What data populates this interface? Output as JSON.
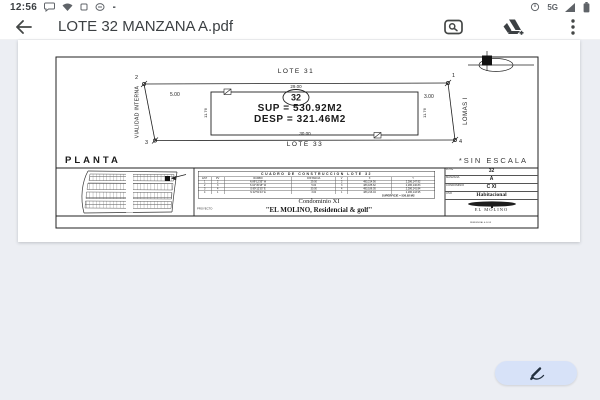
{
  "status_bar": {
    "time": "12:56",
    "network_label": "5G"
  },
  "toolbar": {
    "title": "LOTE 32 MANZANA A.pdf"
  },
  "plan": {
    "lote_top": "LOTE 31",
    "lote_bottom": "LOTE 33",
    "dim_top": "29.00",
    "dim_bottom": "30.00",
    "dim_left": "5.00",
    "dim_right": "3.00",
    "dim_side_left": "11.76",
    "dim_side_right": "11.76",
    "street_left": "VIALIDAD INTERNA",
    "street_right": "LOMAS I",
    "corner_tl": "2",
    "corner_tr": "1",
    "corner_bl": "3",
    "corner_br": "4",
    "lot_number": "32",
    "sup_text": "SUP = 530.92M2",
    "desp_text": "DESP = 321.46M2",
    "planta_label": "PLANTA",
    "scale_note": "*SIN ESCALA"
  },
  "cuadro": {
    "caption": "CUADRO DE CONSTRUCCION - LOTE 32",
    "title": "CUADRO DE CONSTRUCCION   LOTE 32",
    "columns": {
      "est": "EST",
      "pv": "PV",
      "rumbo": "RUMBO",
      "distancia": "DISTANCIA",
      "v": "V",
      "x": "X",
      "y": "Y"
    },
    "rows": [
      {
        "est": "1",
        "pv": "2",
        "rumbo": "N 89°12'35\" W",
        "dist": "29.00",
        "v": "2",
        "x": "483,214.56",
        "y": "2,286,147.92"
      },
      {
        "est": "2",
        "pv": "3",
        "rumbo": "S 04°45'18\" W",
        "dist": "5.00",
        "v": "3",
        "x": "483,185.62",
        "y": "2,286,146.83"
      },
      {
        "est": "3",
        "pv": "4",
        "rumbo": "S 89°12'35\" E",
        "dist": "30.00",
        "v": "4",
        "x": "483,186.05",
        "y": "2,286,141.84"
      },
      {
        "est": "4",
        "pv": "1",
        "rumbo": "N 02°51'44\" E",
        "dist": "3.00",
        "v": "1",
        "x": "483,216.04",
        "y": "2,286,143.95"
      }
    ],
    "footer": "SUPERFICIE = 530.92 M2"
  },
  "condominio": {
    "side_label": "PROYECTO",
    "line1": "Condominio XI",
    "line2": "\"EL MOLINO, Residencial & golf\""
  },
  "title_block": {
    "rows": [
      {
        "label": "LOTE",
        "value": "32"
      },
      {
        "label": "MANZANA",
        "value": "A"
      },
      {
        "label": "CONDOMINIO",
        "value": "C XI"
      },
      {
        "label": "USO",
        "value": "Habitacional"
      }
    ],
    "logo_name": "EL MOLINO",
    "logo_sub": "RESIDENCIAL & GOLF"
  }
}
